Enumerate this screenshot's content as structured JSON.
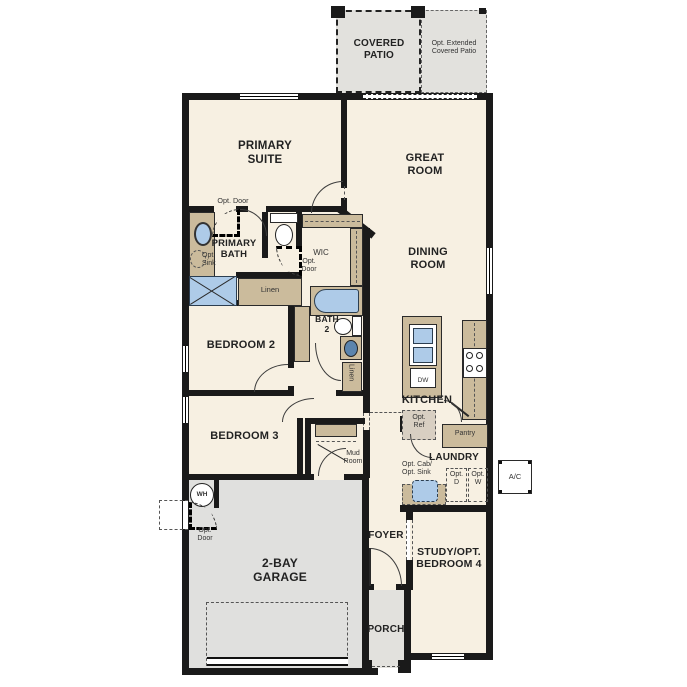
{
  "colors": {
    "floor": "#f7f0e2",
    "hardscape": "#e2e1dd",
    "counter_tan": "#cbbb9c",
    "fixture_blue": "#aecbe8",
    "wall_black": "#1a1a1a",
    "label_text": "#222222"
  },
  "labels": {
    "covered_patio": "COVERED\nPATIO",
    "opt_extended_patio": "Opt. Extended\nCovered Patio",
    "primary_suite": "PRIMARY\nSUITE",
    "great_room": "GREAT\nROOM",
    "dining_room": "DINING\nROOM",
    "opt_door_suite": "Opt. Door",
    "primary_bath": "PRIMARY\nBATH",
    "opt_sink": "Opt.\nSink",
    "wic": "WIC",
    "opt_door_wic": "Opt.\nDoor",
    "linen": "Linen",
    "bath_2": "BATH\n2",
    "bedroom_2": "BEDROOM 2",
    "bedroom_3": "BEDROOM 3",
    "linen_2": "Linen",
    "kitchen": "KITCHEN",
    "dw": "DW",
    "opt_ref": "Opt.\nRef",
    "pantry": "Pantry",
    "laundry": "LAUNDRY",
    "opt_cab_sink": "Opt. Cab/\nOpt. Sink",
    "opt_d": "Opt.\nD",
    "opt_w": "Opt.\nW",
    "ac": "A/C",
    "mud_room": "Mud\nRoom",
    "wh": "WH",
    "opt_door_garage": "Opt.\nDoor",
    "foyer": "FOYER",
    "study_opt_bedroom_4": "STUDY/OPT.\nBEDROOM 4",
    "two_bay_garage": "2-BAY\nGARAGE",
    "porch": "PORCH"
  }
}
